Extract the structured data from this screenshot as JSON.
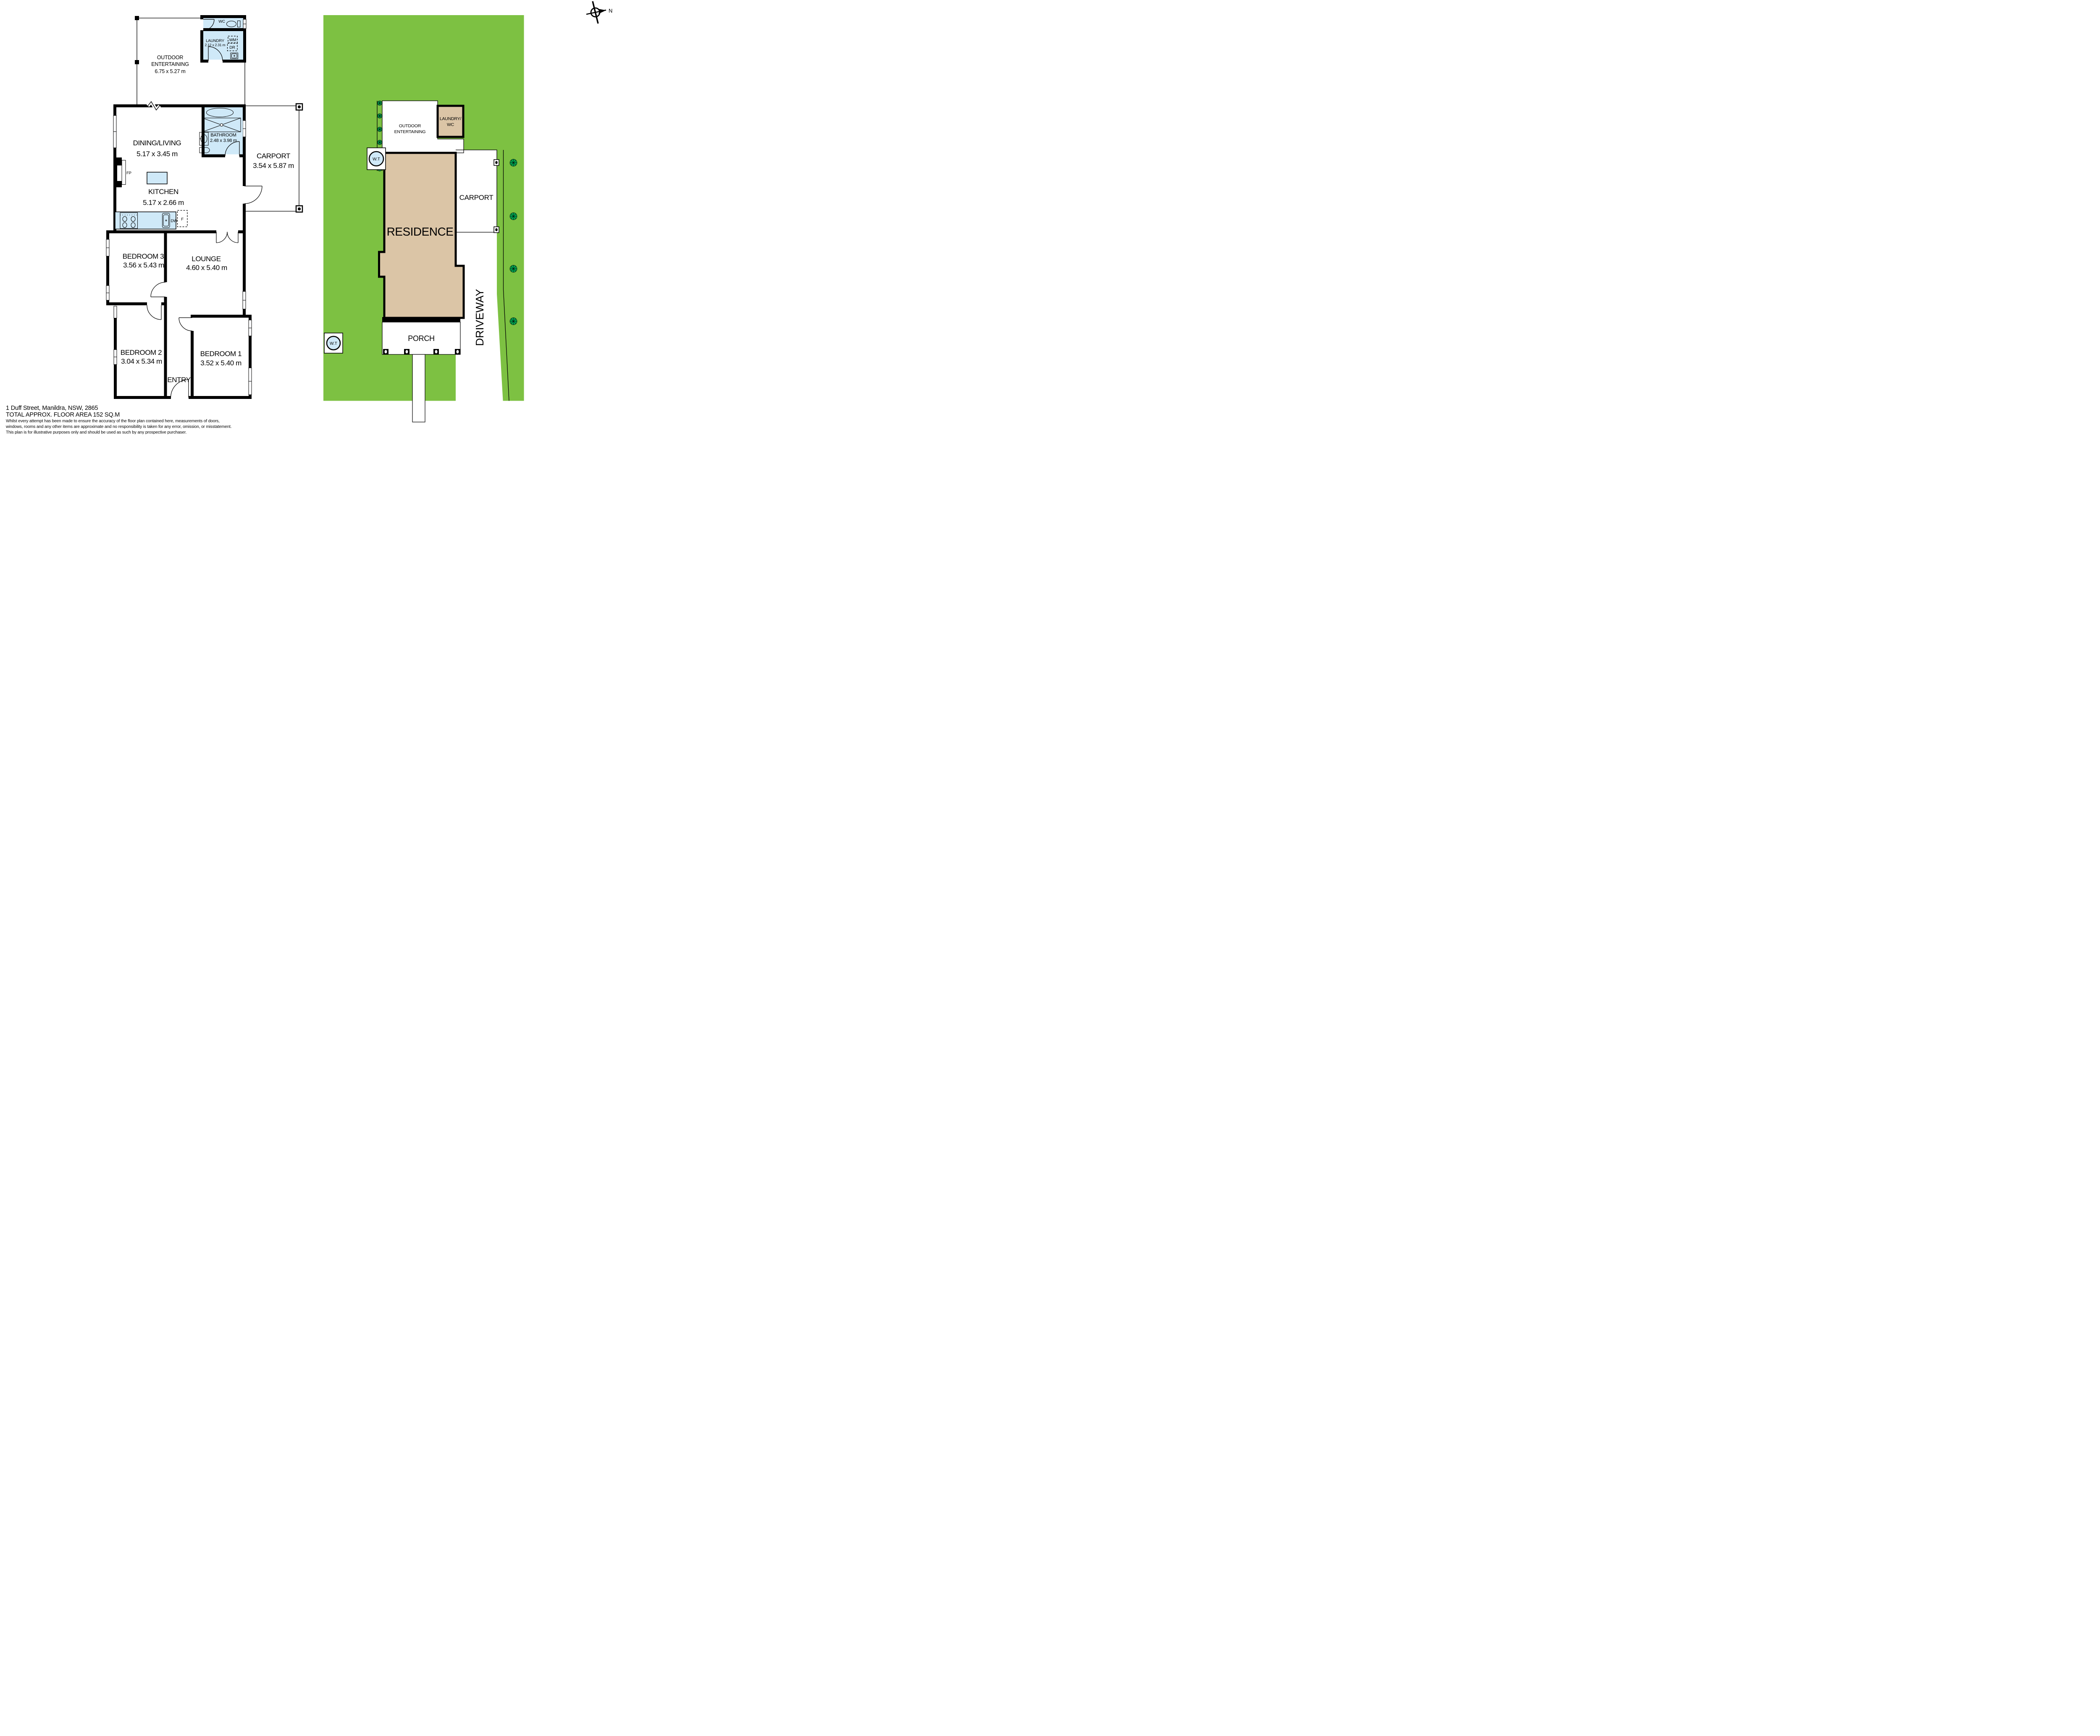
{
  "footer": {
    "address": "1 Duff Street, Manildra, NSW, 2865",
    "floor_area": "TOTAL APPROX. FLOOR AREA 152 SQ.M",
    "disclaimer_line1": "Whilst every attempt has been made to ensure the accuracy of the floor plan contained here, measurements of doors,",
    "disclaimer_line2": "windows, rooms and any other items are approximate and no responsibility is taken for any error, omission, or misstatement.",
    "disclaimer_line3": "This plan is for illustrative purposes only and should be used as such by any prospective purchaser."
  },
  "compass": {
    "north_label": "N"
  },
  "floorplan": {
    "outdoor": {
      "name1": "OUTDOOR",
      "name2": "ENTERTAINING",
      "dims": "6.75 x 5.27 m"
    },
    "wc": {
      "name": "WC"
    },
    "laundry": {
      "name": "LAUNDRY",
      "dims": "2.12 x 2.31 m"
    },
    "dining": {
      "name": "DINING/LIVING",
      "dims": "5.17 x 3.45 m"
    },
    "bathroom": {
      "name": "BATHROOM",
      "dims": "2.48 x 3.98 m"
    },
    "carport": {
      "name": "CARPORT",
      "dims": "3.54 x 5.87 m"
    },
    "kitchen": {
      "name": "KITCHEN",
      "dims": "5.17 x 2.66 m"
    },
    "bed3": {
      "name": "BEDROOM 3",
      "dims": "3.56 x 5.43 m"
    },
    "lounge": {
      "name": "LOUNGE",
      "dims": "4.60 x 5.40 m"
    },
    "bed2": {
      "name": "BEDROOM 2",
      "dims": "3.04 x 5.34 m"
    },
    "bed1": {
      "name": "BEDROOM 1",
      "dims": "3.52 x 5.40 m"
    },
    "entry": {
      "name": "ENTRY"
    },
    "fixtures": {
      "fireplace": "FP",
      "washing_machine": "WM",
      "dryer": "DR",
      "dishwasher": "DW",
      "fridge": "F"
    }
  },
  "siteplan": {
    "outdoor1": "OUTDOOR",
    "outdoor2": "ENTERTAINING",
    "laundry1": "LAUNDRY/",
    "laundry2": "WC",
    "carport": "CARPORT",
    "residence": "RESIDENCE",
    "porch": "PORCH",
    "driveway": "DRIVEWAY",
    "water_tank": "W.T"
  },
  "colors": {
    "wet_area_blue": "#cfe9f8",
    "grass_green": "#7dc142",
    "building_tan": "#dbc5a6",
    "shrub_green": "#00a650",
    "wall_black": "#000000"
  }
}
